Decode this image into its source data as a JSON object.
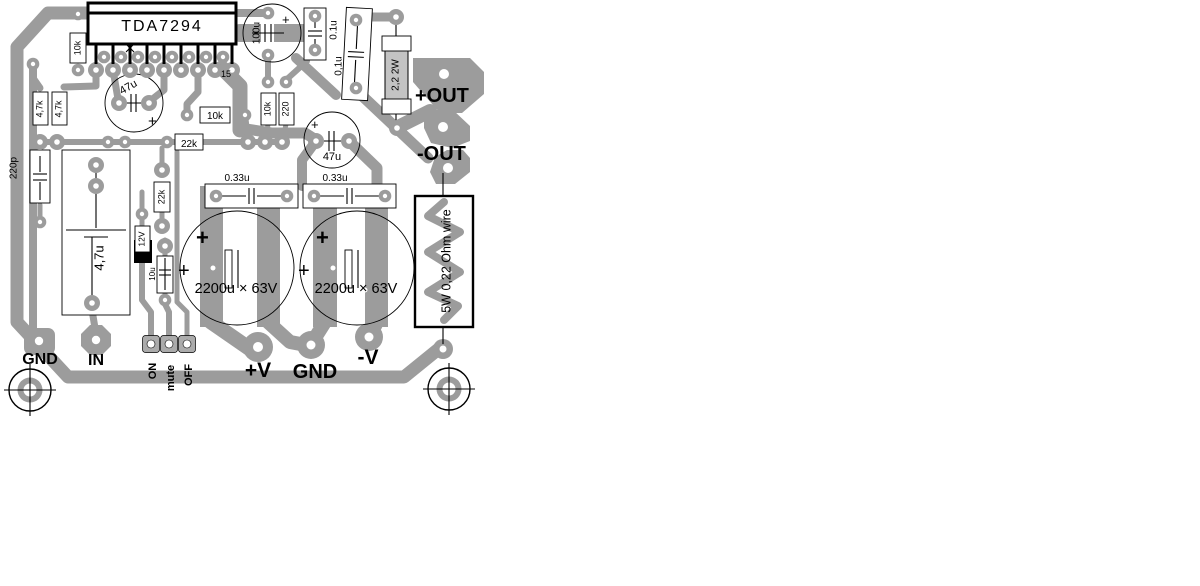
{
  "board": {
    "ic": {
      "label": "TDA7294",
      "pin15": "15"
    },
    "power_pads": {
      "out_pos": "+OUT",
      "out_neg": "-OUT",
      "v_pos": "+V",
      "gnd": "GND",
      "v_neg": "-V"
    },
    "connectors": {
      "gnd": "GND",
      "input": "IN",
      "on": "ON",
      "mute": "mute",
      "off": "OFF"
    },
    "components": {
      "r_10k_pin": "10k",
      "r_4k7_a": "4,7k",
      "r_4k7_b": "4,7k",
      "c_220p": "220p",
      "film_cap_brand": "LUCOL",
      "film_cap_value": "4,7u",
      "c_47u_top": "47u",
      "c_47u_mid": "47u",
      "r_10k_h": "10k",
      "r_22k_h": "22k",
      "r_10k_v": "10k",
      "r_220_v": "220",
      "c_100u": "100u",
      "c_01u_a": "0.1u",
      "c_01u_b": "0,1u",
      "r_2r2_2w": "2,2 2W",
      "r_22k_v": "22k",
      "d_zener": "12V",
      "c_10u": "10u",
      "c_033_a": "0.33u",
      "c_033_b": "0.33u",
      "c_2200_a": "2200u × 63V",
      "c_2200_b": "2200u × 63V",
      "r_wire": "5W 0,22 Ohm wire",
      "plus": "+"
    },
    "colors": {
      "trace": "#9c9c9c",
      "silkscreen": "#000000",
      "background": "#ffffff"
    }
  }
}
